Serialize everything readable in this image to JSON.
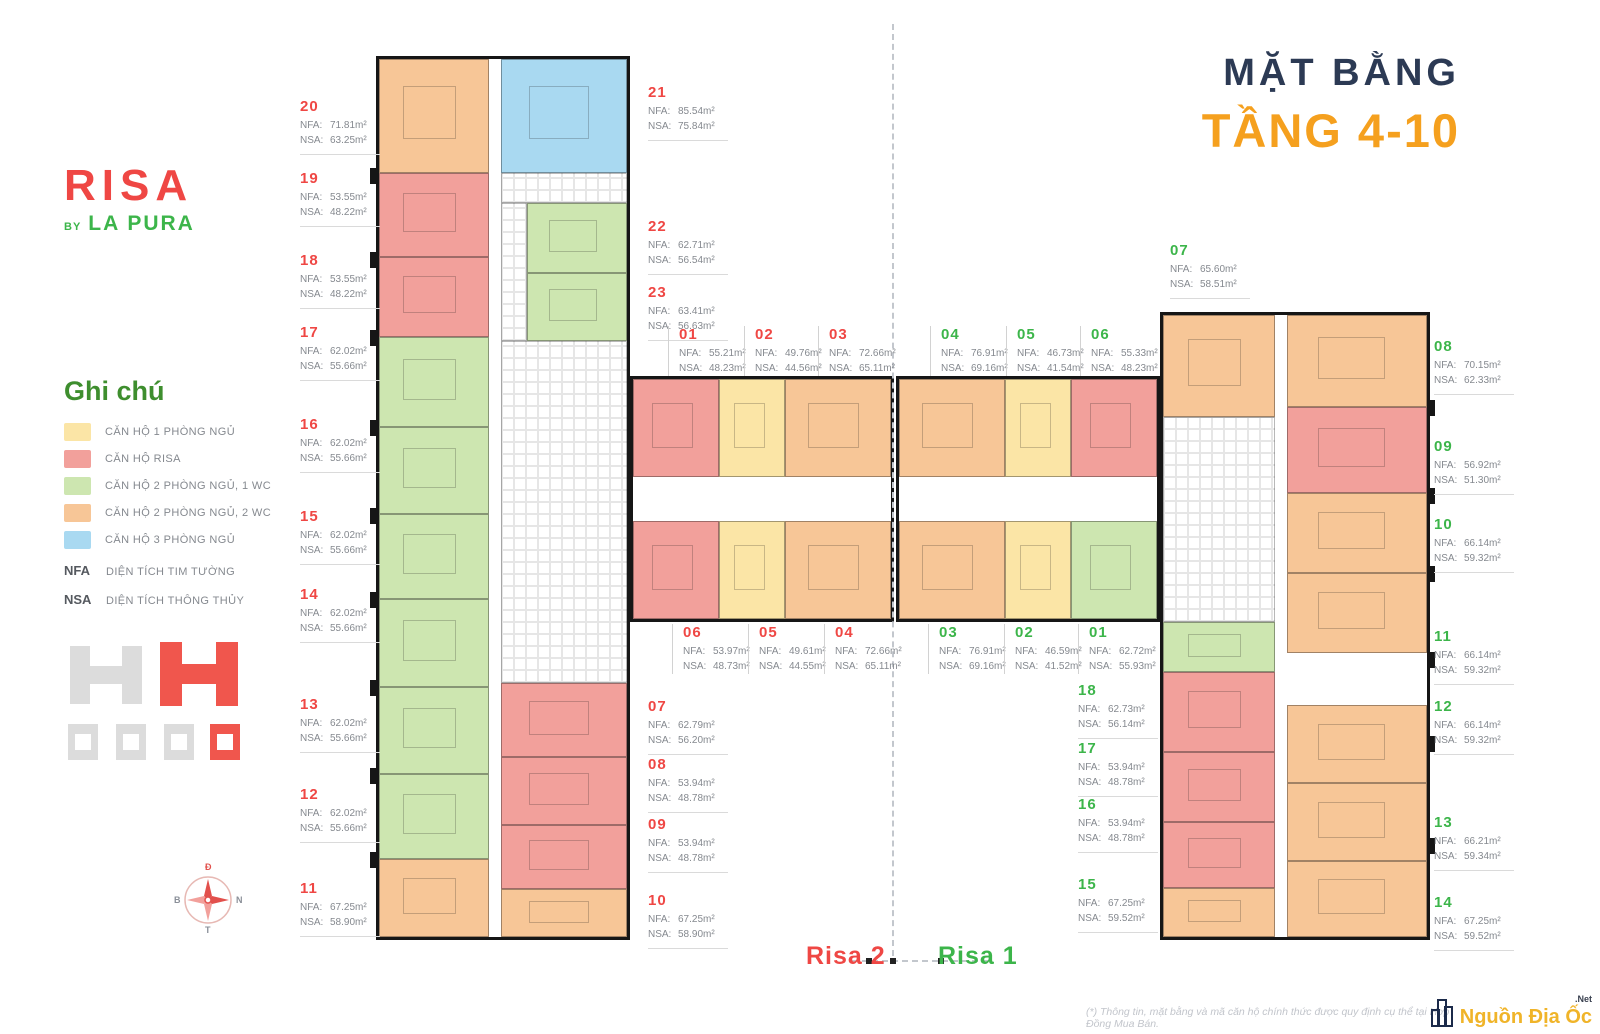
{
  "page": {
    "title_line1": "MẶT BẰNG",
    "title_line2": "TẦNG 4-10"
  },
  "logo": {
    "name": "RISA",
    "by": "BY",
    "brand": "LA PURA"
  },
  "accents": {
    "risa2_red": "#EF4744",
    "risa1_green": "#3CB54A",
    "title_navy": "#2C3A54",
    "title_orange": "#F5A01E",
    "legend_green": "#3E8E2E"
  },
  "palette": {
    "yellow": "#FBE5A6",
    "pink": "#F2A09B",
    "green": "#CDE6B0",
    "orange": "#F7C697",
    "blue": "#A9D9F1"
  },
  "labels": {
    "nfa": "NFA:",
    "nsa": "NSA:"
  },
  "legend": {
    "title": "Ghi chú",
    "items": [
      {
        "label": "CĂN HỘ 1 PHÒNG NGỦ",
        "color": "#FBE5A6"
      },
      {
        "label": "CĂN HỘ RISA",
        "color": "#F2A09B"
      },
      {
        "label": "CĂN HỘ 2 PHÒNG NGỦ, 1 WC",
        "color": "#CDE6B0"
      },
      {
        "label": "CĂN HỘ 2 PHÒNG NGỦ, 2 WC",
        "color": "#F7C697"
      },
      {
        "label": "CĂN HỘ 3 PHÒNG NGỦ",
        "color": "#A9D9F1"
      }
    ],
    "abbr": [
      {
        "key": "NFA",
        "label": "DIỆN TÍCH TIM TƯỜNG"
      },
      {
        "key": "NSA",
        "label": "DIỆN TÍCH THÔNG THỦY"
      }
    ]
  },
  "compass": {
    "top": "Đ",
    "right": "N",
    "bottom": "T",
    "left": "B"
  },
  "buildings": {
    "risa2": {
      "name": "Risa 2",
      "units": [
        {
          "no": "01",
          "nfa": "55.21m²",
          "nsa": "48.23m²"
        },
        {
          "no": "02",
          "nfa": "49.76m²",
          "nsa": "44.56m²"
        },
        {
          "no": "03",
          "nfa": "72.66m²",
          "nsa": "65.11m²"
        },
        {
          "no": "04",
          "nfa": "72.66m²",
          "nsa": "65.11m²"
        },
        {
          "no": "05",
          "nfa": "49.61m²",
          "nsa": "44.55m²"
        },
        {
          "no": "06",
          "nfa": "53.97m²",
          "nsa": "48.73m²"
        },
        {
          "no": "07",
          "nfa": "62.79m²",
          "nsa": "56.20m²"
        },
        {
          "no": "08",
          "nfa": "53.94m²",
          "nsa": "48.78m²"
        },
        {
          "no": "09",
          "nfa": "53.94m²",
          "nsa": "48.78m²"
        },
        {
          "no": "10",
          "nfa": "67.25m²",
          "nsa": "58.90m²"
        },
        {
          "no": "11",
          "nfa": "67.25m²",
          "nsa": "58.90m²"
        },
        {
          "no": "12",
          "nfa": "62.02m²",
          "nsa": "55.66m²"
        },
        {
          "no": "13",
          "nfa": "62.02m²",
          "nsa": "55.66m²"
        },
        {
          "no": "14",
          "nfa": "62.02m²",
          "nsa": "55.66m²"
        },
        {
          "no": "15",
          "nfa": "62.02m²",
          "nsa": "55.66m²"
        },
        {
          "no": "16",
          "nfa": "62.02m²",
          "nsa": "55.66m²"
        },
        {
          "no": "17",
          "nfa": "62.02m²",
          "nsa": "55.66m²"
        },
        {
          "no": "18",
          "nfa": "53.55m²",
          "nsa": "48.22m²"
        },
        {
          "no": "19",
          "nfa": "53.55m²",
          "nsa": "48.22m²"
        },
        {
          "no": "20",
          "nfa": "71.81m²",
          "nsa": "63.25m²"
        },
        {
          "no": "21",
          "nfa": "85.54m²",
          "nsa": "75.84m²"
        },
        {
          "no": "22",
          "nfa": "62.71m²",
          "nsa": "56.54m²"
        },
        {
          "no": "23",
          "nfa": "63.41m²",
          "nsa": "56.63m²"
        }
      ]
    },
    "risa1": {
      "name": "Risa 1",
      "units": [
        {
          "no": "01",
          "nfa": "62.72m²",
          "nsa": "55.93m²"
        },
        {
          "no": "02",
          "nfa": "46.59m²",
          "nsa": "41.52m²"
        },
        {
          "no": "03",
          "nfa": "76.91m²",
          "nsa": "69.16m²"
        },
        {
          "no": "04",
          "nfa": "76.91m²",
          "nsa": "69.16m²"
        },
        {
          "no": "05",
          "nfa": "46.73m²",
          "nsa": "41.54m²"
        },
        {
          "no": "06",
          "nfa": "55.33m²",
          "nsa": "48.23m²"
        },
        {
          "no": "07",
          "nfa": "65.60m²",
          "nsa": "58.51m²"
        },
        {
          "no": "08",
          "nfa": "70.15m²",
          "nsa": "62.33m²"
        },
        {
          "no": "09",
          "nfa": "56.92m²",
          "nsa": "51.30m²"
        },
        {
          "no": "10",
          "nfa": "66.14m²",
          "nsa": "59.32m²"
        },
        {
          "no": "11",
          "nfa": "66.14m²",
          "nsa": "59.32m²"
        },
        {
          "no": "12",
          "nfa": "66.14m²",
          "nsa": "59.32m²"
        },
        {
          "no": "13",
          "nfa": "66.21m²",
          "nsa": "59.34m²"
        },
        {
          "no": "14",
          "nfa": "67.25m²",
          "nsa": "59.52m²"
        },
        {
          "no": "15",
          "nfa": "67.25m²",
          "nsa": "59.52m²"
        },
        {
          "no": "16",
          "nfa": "53.94m²",
          "nsa": "48.78m²"
        },
        {
          "no": "17",
          "nfa": "53.94m²",
          "nsa": "48.78m²"
        },
        {
          "no": "18",
          "nfa": "62.73m²",
          "nsa": "56.14m²"
        }
      ]
    }
  },
  "footer": {
    "disclaimer": "(*) Thông tin, mặt bằng và mã căn hộ chính thức được quy định cụ thể tại Hợp Đồng Mua Bán.",
    "watermark": "Nguồn Địa Ốc",
    "watermark_suffix": ".Net"
  }
}
